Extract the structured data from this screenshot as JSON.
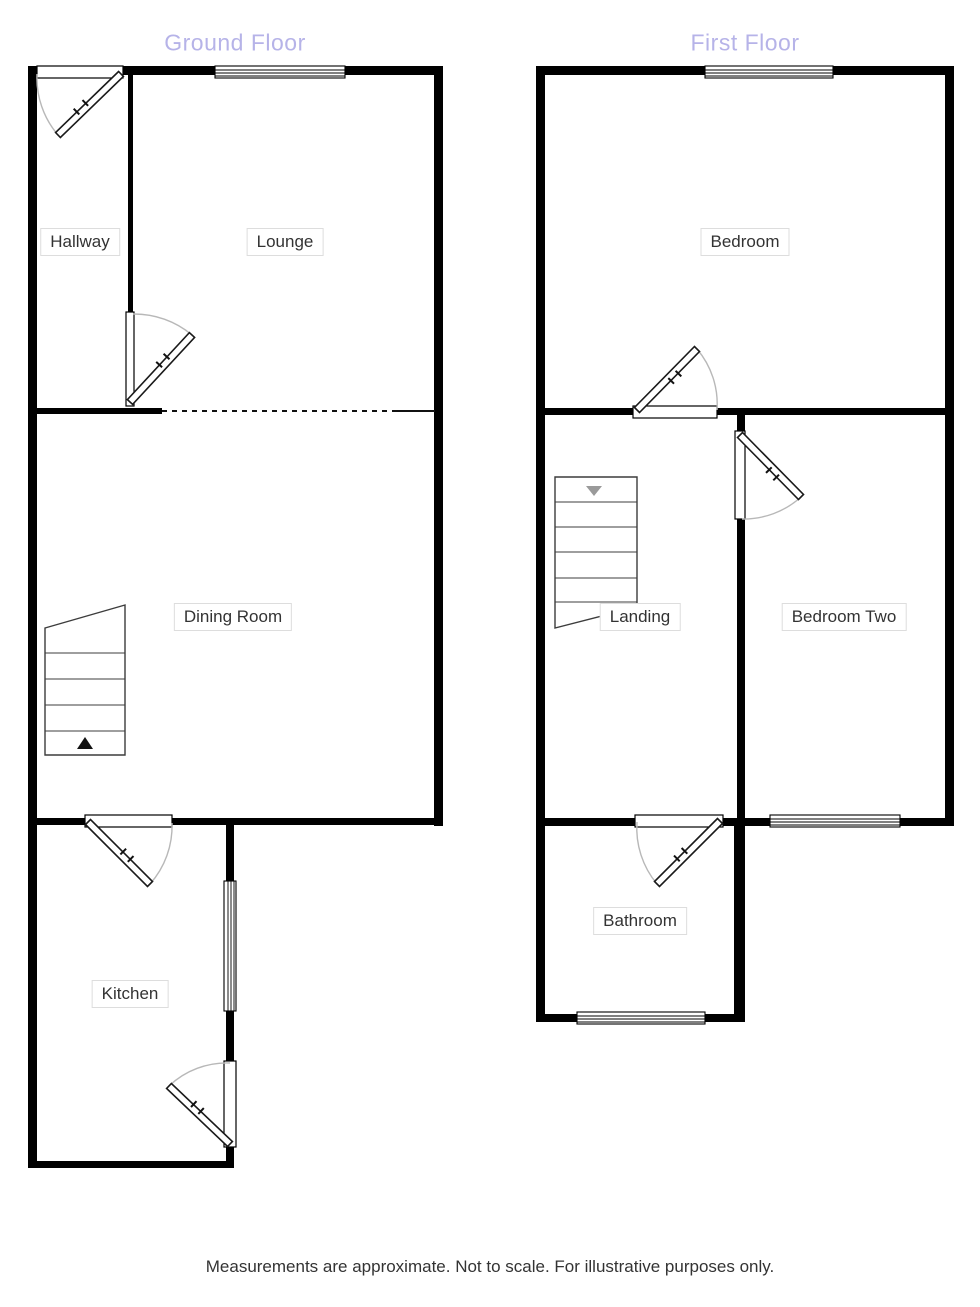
{
  "colors": {
    "background": "#ffffff",
    "wall": "#000000",
    "floor_title": "#b6b3e8",
    "room_label_text": "#333333",
    "room_label_border": "#dddddd",
    "door_arc": "#b8b8b8",
    "stair_lines": "#3c3c3c",
    "up_arrow": "#111111",
    "down_arrow": "#9a9a9a"
  },
  "floors": [
    {
      "title": "Ground Floor",
      "rooms": [
        {
          "label": "Hallway"
        },
        {
          "label": "Lounge"
        },
        {
          "label": "Dining Room"
        },
        {
          "label": "Kitchen"
        }
      ]
    },
    {
      "title": "First Floor",
      "rooms": [
        {
          "label": "Bedroom"
        },
        {
          "label": "Landing"
        },
        {
          "label": "Bedroom Two"
        },
        {
          "label": "Bathroom"
        }
      ]
    }
  ],
  "footer": {
    "disclaimer": "Measurements are approximate. Not to scale. For illustrative purposes only."
  }
}
